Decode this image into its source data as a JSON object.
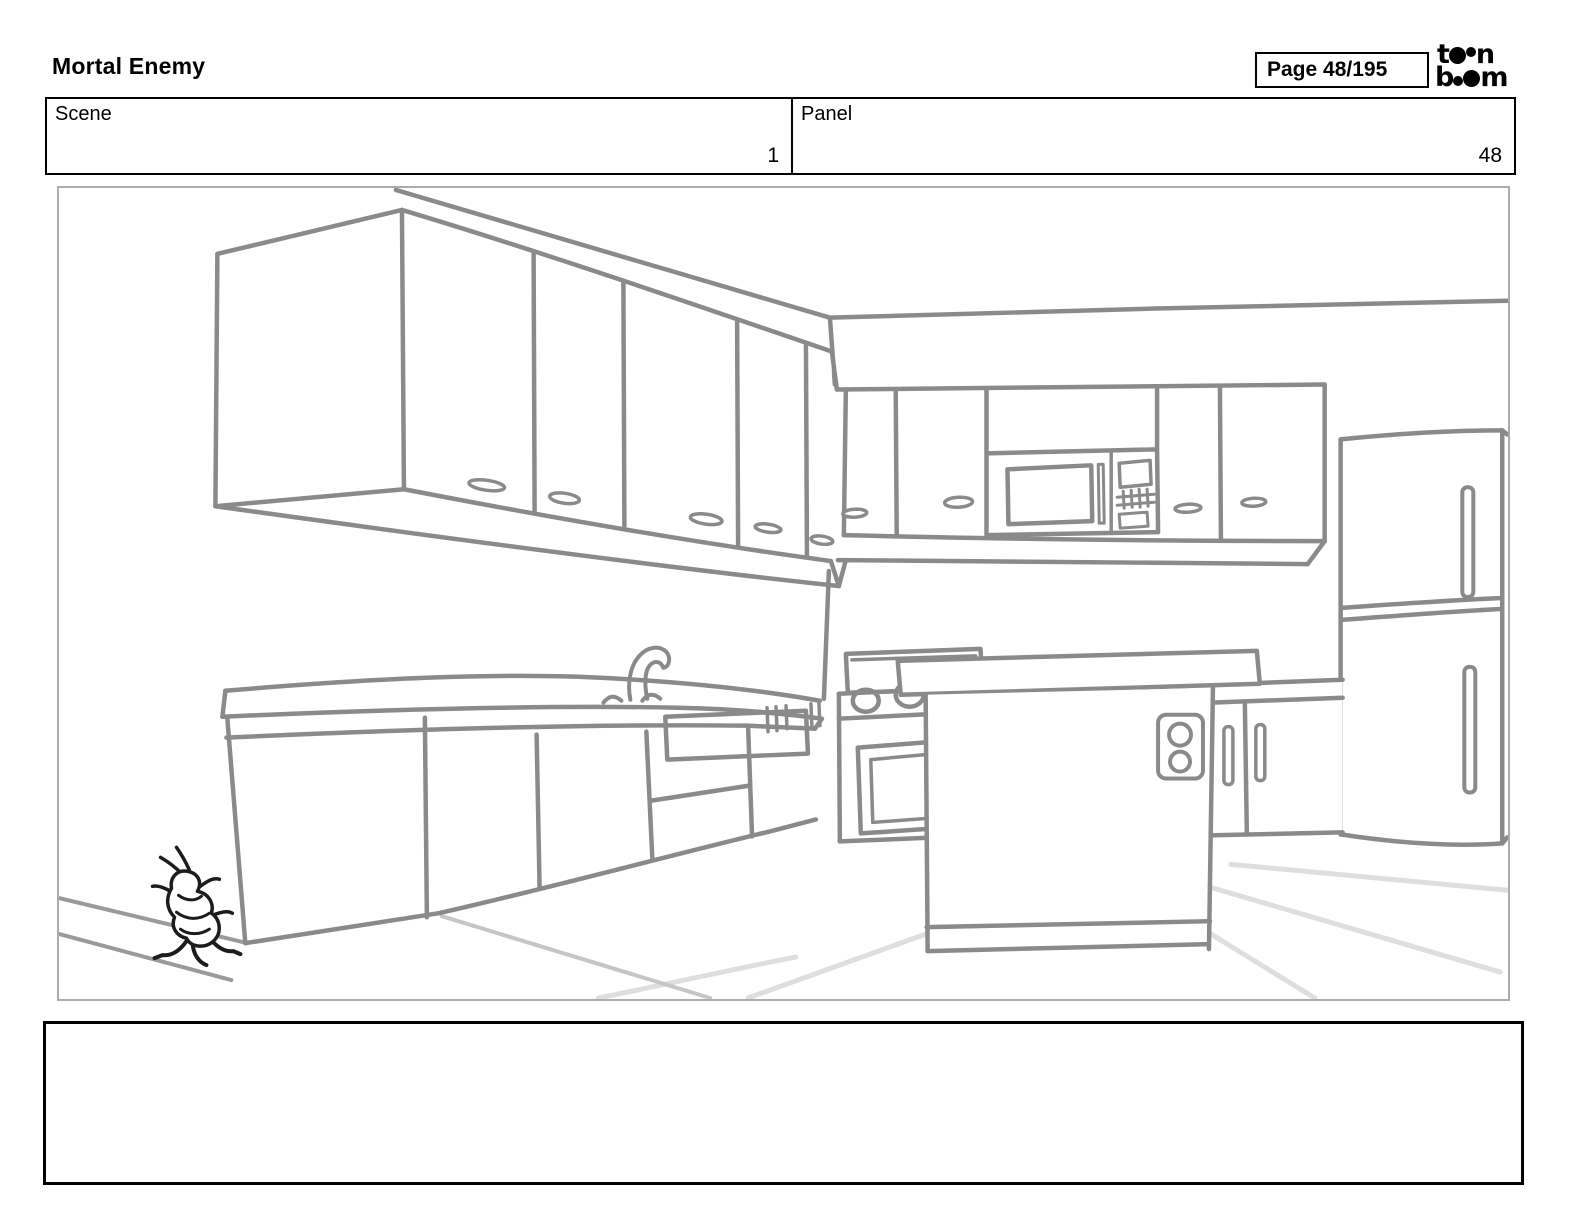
{
  "header": {
    "title": "Mortal Enemy",
    "page_label": "Page 48/195",
    "logo": {
      "name": "toon-boom",
      "line1_start": "t",
      "line1_end": "n",
      "line2_start": "b",
      "line2_end": "m"
    }
  },
  "info_table": {
    "scene_label": "Scene",
    "scene_value": "1",
    "panel_label": "Panel",
    "panel_value": "48"
  },
  "panel_drawing": {
    "description": "Hand-drawn line-art kitchen: upper wall cabinets in perspective on the left, back wall cabinets with built-in microwave, refrigerator on the right, base counter with sink faucet and dishwasher, stove, center island with power outlet, tiled floor, and a small cartoon cockroach running on the floor at lower left",
    "stroke_color": "#8a8a8a",
    "bug_color": "#1c1c1c",
    "floor_line_color": "#dedede",
    "floor_seam_color": "#c6c6c6",
    "baseboard_color": "#9a9a9a",
    "frame_border_color": "#acacac"
  },
  "caption": {
    "text": ""
  }
}
